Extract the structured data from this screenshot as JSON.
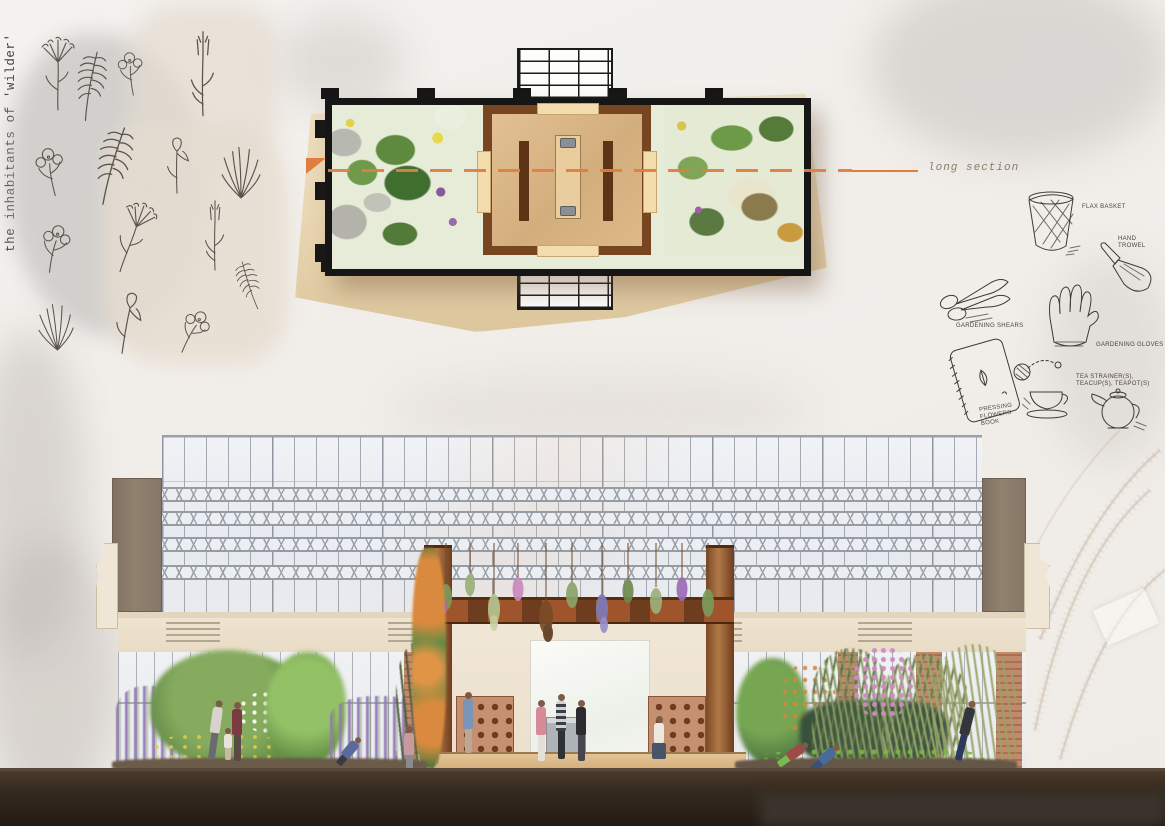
{
  "board": {
    "vertical_title": "the inhabitants of 'wilder'"
  },
  "plan": {
    "section_label": "long section"
  },
  "tools": {
    "basket_label": "FLAX BASKET",
    "trowel_label": "HAND TROWEL",
    "shears_label": "GARDENING SHEARS",
    "gloves_label": "GARDENING GLOVES",
    "book_label": "PRESSING FLOWERS BOOK",
    "tea_label": "TEA STRAINER(S), TEACUP(S), TEAPOT(S)"
  },
  "colors": {
    "section_line": "#E07E42",
    "deck_wood": "#D9B88C",
    "copper_column": "#A0663A",
    "glass": "#EBEEF2",
    "lavender": "#9478B8",
    "foliage_green": "#6B9A4E",
    "soil": "#2E241B",
    "paper": "#F1EEEA"
  }
}
